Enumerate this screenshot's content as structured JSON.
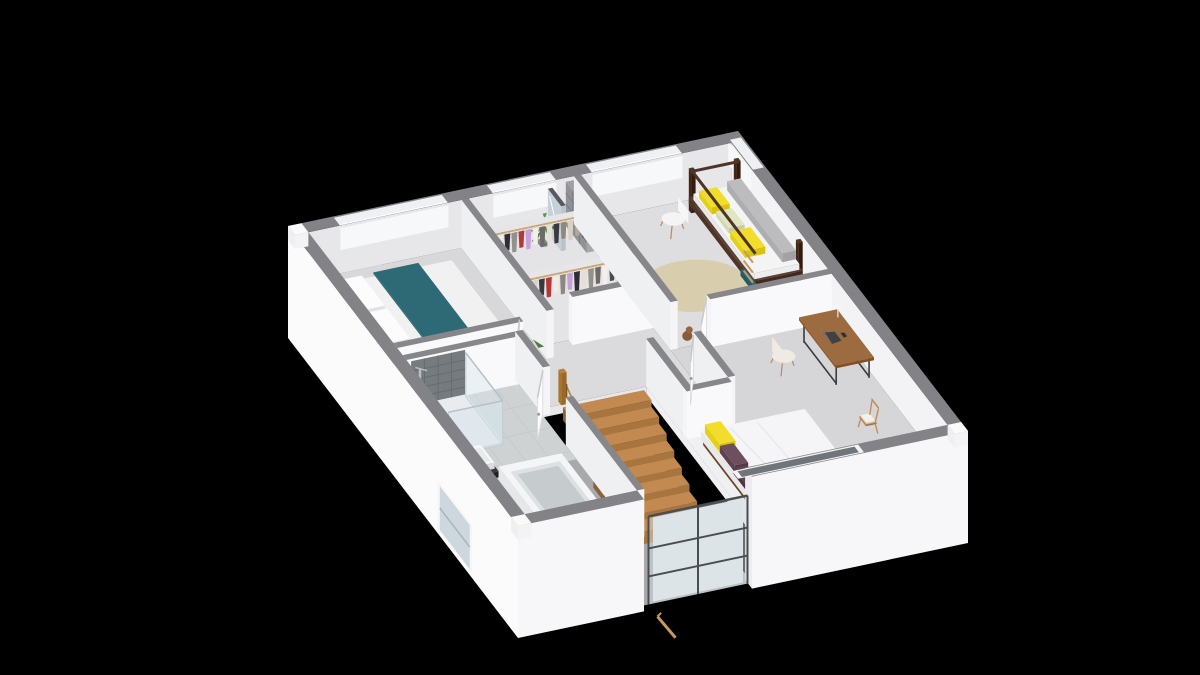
{
  "meta": {
    "content_type": "3d-floorplan-render",
    "view": "isometric-cutaway-upper-floor",
    "visible_text": []
  },
  "palette": {
    "bg": "#000000",
    "band": "#828287",
    "wall_top": "#87878b",
    "cap_white": "#fafafb",
    "ext_wall": "#fbfbfc",
    "ext_wall_b": "#f7f7f9",
    "jamb": "#ededef",
    "inner_nw": "#e7e7e9",
    "inner_ne": "#f3f3f5",
    "window_light": "#f7f8fa",
    "face_v": "#eff0f2",
    "face_u": "#f9f9fb",
    "face_cap": "#f5f5f7",
    "window_band": "#eef0f3",
    "window_line": "#ffffff",
    "se_window_rim": "#f2f3f5",
    "se_window_glass": "#70757b",
    "floor_master": "#d8d8da",
    "floor_closet": "#e4e4e6",
    "floor_kids": "#dedee0",
    "floor_hall": "#dbdbdd",
    "floor_bath": "#ced2d3",
    "floor_bed2": "#d6d6d8",
    "tile_line": "#c3c7c8",
    "void_floor": "#a9a9ac",
    "slab": "#f0f0f2",
    "slab_b": "#e8e8ea",
    "tread": "#c28a50",
    "tread_side": "#8a6038",
    "tread_front": "#a8753e",
    "rail": "#b5823f",
    "baluster": "#3c3c40",
    "glass": "#cfdde2",
    "glass_frame": "#4a4c50",
    "lower_wall": "#e9ebed",
    "lower_rail": "#c89a62",
    "teal": "#2e6a76",
    "teal_side": "#2a616c",
    "duvet": "#f1f1f2",
    "pillow": "#fcfcfd",
    "bed_wood": "#6f4f36",
    "bench": "#aaaaad",
    "rug": "#d7cbaa",
    "bunk_wood": "#4e3527",
    "mattress": "#f4f4f5",
    "cushion_grey": "#bcbcbf",
    "yellow": "#f2de2a",
    "pale_green": "#e0e6c2",
    "ladder": "#c89a62",
    "shelf_white": "#f6f6f7",
    "mirror_glass": "#c6d1d7",
    "mirror_bar": "#55585c",
    "cubby": "#8f9396",
    "cubby_line": "#797d80",
    "rack_shelf": "#e6e6e9",
    "rack_edge": "#d4d4d8",
    "rack_rail": "#caa36b",
    "hanger": "#d0d0d3",
    "plant": "#5f9150",
    "plant_dark": "#4e7d42",
    "pot": "#8f8f92",
    "teddy": "#8a5a3a",
    "teddy_head": "#96653f",
    "desk_top": "#9c6b40",
    "desk_leg": "#3c3c40",
    "laptop_base": "#3f4145",
    "laptop_screen": "#9aa0a5",
    "laptop_inner": "#6b7075",
    "chair_cream": "#efeae2",
    "chair_white": "#f4f4f5",
    "chair_leg": "#b98a57",
    "chair_wood": "#c08a50",
    "cushion_white": "#f3f0ea",
    "plum": "#6d4f5d",
    "plum_dark": "#5d4250",
    "bed2_wood": "#7a5535",
    "duvet2": "#f5f5f7",
    "shower_tile": "#757b7f",
    "shower_tile_line": "#64696d",
    "tray": "#e9ecee",
    "glass_shower": "#d7e4ea",
    "glass_edge": "#c2ced4",
    "chrome": "#b9bfc3",
    "counter": "#3a3a3d",
    "basin": "#f6f6f8",
    "basin_inner": "#e8eaec",
    "shelf_wood": "#bb8b57",
    "tub": "#f4f5f6",
    "tub_inner": "#dde1e3",
    "tub_deep": "#c6cbce",
    "door": "#fcfcfd",
    "door_edge": "#d8d8da",
    "door_top": "#c9c9cc",
    "handle": "#9a9a9e"
  },
  "layout": {
    "projection": {
      "origin": [
        288,
        226
      ],
      "u": [
        4.5,
        -0.95
      ],
      "v": [
        2.3,
        3.0
      ],
      "wall_h": 48,
      "ext_depth": 112
    },
    "shell": {
      "windows_nw": [
        [
          10,
          34
        ],
        [
          44,
          58
        ],
        [
          66,
          86
        ]
      ],
      "window_ne": [
        2,
        12
      ],
      "window_se": [
        50,
        76
      ],
      "facade_gap": [
        28,
        52
      ]
    },
    "floors": {
      "master": [
        3,
        3,
        37,
        40
      ],
      "closet": [
        37,
        3,
        62,
        36
      ],
      "kids": [
        62,
        3,
        97,
        45
      ],
      "bath": [
        3,
        44,
        28,
        97
      ],
      "hall": [
        [
          37,
          36
        ],
        [
          62,
          36
        ],
        [
          62,
          70
        ],
        [
          52,
          70
        ],
        [
          52,
          54
        ],
        [
          28,
          54
        ],
        [
          28,
          44
        ],
        [
          3,
          44
        ],
        [
          3,
          40
        ],
        [
          37,
          40
        ]
      ],
      "bed2": [
        [
          62,
          45
        ],
        [
          97,
          45
        ],
        [
          97,
          97
        ],
        [
          52,
          97
        ],
        [
          52,
          70
        ],
        [
          62,
          70
        ]
      ],
      "tile_u": [
        8,
        13,
        18,
        23
      ],
      "tile_v": [
        52,
        60,
        68,
        76,
        84,
        92
      ]
    },
    "walls": {
      "w_master_closet": [
        "v",
        37,
        3,
        40
      ],
      "w_closet_kids": [
        "v",
        62,
        3,
        45
      ],
      "w_master_south": [
        "u",
        40,
        3,
        31
      ],
      "w_closet_south": [
        "u",
        36,
        44,
        62
      ],
      "w_kids_south": [
        "u",
        45,
        70,
        97
      ],
      "w_bed2_west": [
        "v",
        62,
        55,
        70
      ],
      "w_bed2_north2": [
        "u",
        70,
        52,
        62
      ],
      "w_stair_east": [
        "v",
        52,
        54,
        97
      ],
      "w_bath_north": [
        "u",
        44,
        3,
        28
      ],
      "w_bath_east_a": [
        "v",
        28,
        44,
        56
      ],
      "w_bath_east_b": [
        "v",
        28,
        66,
        97
      ]
    },
    "doors": {
      "master": [
        [
          31,
          40
        ],
        [
          26.5,
          47.5
        ]
      ],
      "kids": [
        [
          70,
          45
        ],
        [
          65,
          52.5
        ]
      ],
      "bed2": [
        [
          62,
          55
        ],
        [
          57.5,
          62.5
        ]
      ],
      "bath": [
        [
          28,
          56
        ],
        [
          23,
          63.5
        ]
      ]
    },
    "stairs": {
      "well": [
        28,
        54,
        52,
        100
      ],
      "flight_u": [
        33.5,
        51.5
      ],
      "v0": 54,
      "n": 8,
      "depth": 3.3,
      "drop": 7,
      "top_z": -3,
      "glass_u": [
        29,
        51
      ],
      "glass_z": [
        30,
        -58
      ],
      "lower_rail": [
        [
          31,
          -72
        ],
        [
          35,
          -97
        ]
      ]
    },
    "closet": {
      "rows": [
        {
          "v": 12,
          "u0": 40,
          "u1": 61
        },
        {
          "v": 27,
          "u0": 40,
          "u1": 61
        }
      ],
      "mirror": [
        55.6,
        4.2,
        56.6,
        10
      ],
      "cubby": [
        60.2,
        3,
        62,
        12
      ],
      "plant": [
        53,
        7
      ]
    },
    "kids": {
      "shelf": [
        63.5,
        4,
        67,
        20
      ],
      "chair": [
        80,
        11
      ],
      "rug": {
        "c": [
          76,
          28
        ],
        "r": [
          11,
          8
        ]
      },
      "bunk": [
        86,
        6,
        97,
        34
      ],
      "teddy": [
        67,
        42.5
      ]
    },
    "master": {
      "bed": [
        6,
        10,
        31.5,
        33.5
      ],
      "bench": [
        2.6,
        12,
        5.6,
        30
      ],
      "lamp": [
        4.1,
        10.5
      ],
      "plant": [
        35.2,
        37.6
      ]
    },
    "bath": {
      "shower": [
        4,
        46,
        16,
        62
      ],
      "sinks": [
        [
          4,
          66,
          9,
          74
        ],
        [
          4,
          78,
          9,
          86
        ]
      ],
      "tub": [
        10,
        72,
        24,
        94
      ]
    },
    "bed2": {
      "desk": [
        88,
        50,
        96.5,
        66
      ],
      "desk_chair": [
        81,
        57
      ],
      "bed": [
        54,
        74,
        77,
        94
      ],
      "chair": [
        88,
        80
      ]
    },
    "lower": {
      "sw_window": [
        66,
        79,
        -14,
        -58
      ]
    }
  },
  "garments": {
    "row1": [
      "#efece3",
      "#2e2e32",
      "#94908a",
      "#b53737",
      "#c79fd9",
      "#f1efe9",
      "#6e6a66",
      "#e6e0d2",
      "#3a3a3e",
      "#8e897f",
      "#d8d1c3",
      "#b1a89e",
      "#53504c"
    ],
    "row2": [
      "#d9d2c6",
      "#3a3a3e",
      "#b53737",
      "#efece3",
      "#8e897f",
      "#c79fd9",
      "#2e2e32",
      "#e6e0d2",
      "#94908a",
      "#6e6a66",
      "#f1efe9",
      "#4b4b4f",
      "#baa27a"
    ]
  },
  "toys": [
    "#cc3a3a",
    "#3a6fd8",
    "#3fae4a",
    "#e8c832",
    "#9a5fc0",
    "#e87a2a"
  ]
}
